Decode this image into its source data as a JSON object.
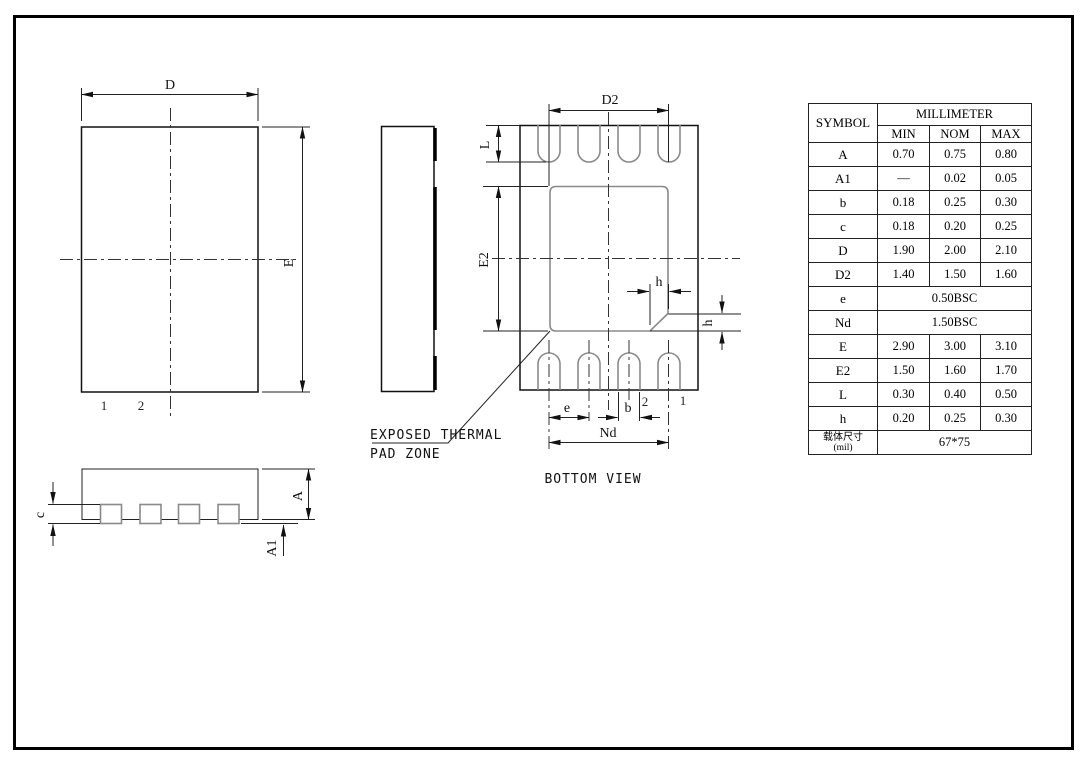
{
  "drawing": {
    "top_view": {
      "dim_d": "D",
      "dim_e": "E",
      "pin1": "1",
      "pin2": "2"
    },
    "bottom_view": {
      "dim_d2": "D2",
      "dim_e2": "E2",
      "dim_l": "L",
      "dim_h_top": "h",
      "dim_h_right": "h",
      "dim_e": "e",
      "dim_b": "b",
      "dim_nd": "Nd",
      "pin1": "1",
      "pin2": "2",
      "thermal_label_line1": "EXPOSED THERMAL",
      "thermal_label_line2": "PAD ZONE",
      "caption": "BOTTOM VIEW"
    },
    "side_view": {
      "dim_c": "c",
      "dim_a": "A",
      "dim_a1": "A1"
    }
  },
  "table": {
    "header": {
      "symbol": "SYMBOL",
      "unit": "MILLIMETER",
      "min": "MIN",
      "nom": "NOM",
      "max": "MAX"
    },
    "rows": [
      {
        "symbol": "A",
        "min": "0.70",
        "nom": "0.75",
        "max": "0.80"
      },
      {
        "symbol": "A1",
        "min": "—",
        "nom": "0.02",
        "max": "0.05"
      },
      {
        "symbol": "b",
        "min": "0.18",
        "nom": "0.25",
        "max": "0.30"
      },
      {
        "symbol": "c",
        "min": "0.18",
        "nom": "0.20",
        "max": "0.25"
      },
      {
        "symbol": "D",
        "min": "1.90",
        "nom": "2.00",
        "max": "2.10"
      },
      {
        "symbol": "D2",
        "min": "1.40",
        "nom": "1.50",
        "max": "1.60"
      },
      {
        "symbol": "e",
        "span": "0.50BSC"
      },
      {
        "symbol": "Nd",
        "span": "1.50BSC"
      },
      {
        "symbol": "E",
        "min": "2.90",
        "nom": "3.00",
        "max": "3.10"
      },
      {
        "symbol": "E2",
        "min": "1.50",
        "nom": "1.60",
        "max": "1.70"
      },
      {
        "symbol": "L",
        "min": "0.30",
        "nom": "0.40",
        "max": "0.50"
      },
      {
        "symbol": "h",
        "min": "0.20",
        "nom": "0.25",
        "max": "0.30"
      },
      {
        "symbol_line1": "载体尺寸",
        "symbol_line2": "(mil)",
        "span": "67*75"
      }
    ]
  },
  "colors": {
    "outline": "#111111",
    "pad_gray": "#8a8a8a",
    "background": "#ffffff"
  }
}
